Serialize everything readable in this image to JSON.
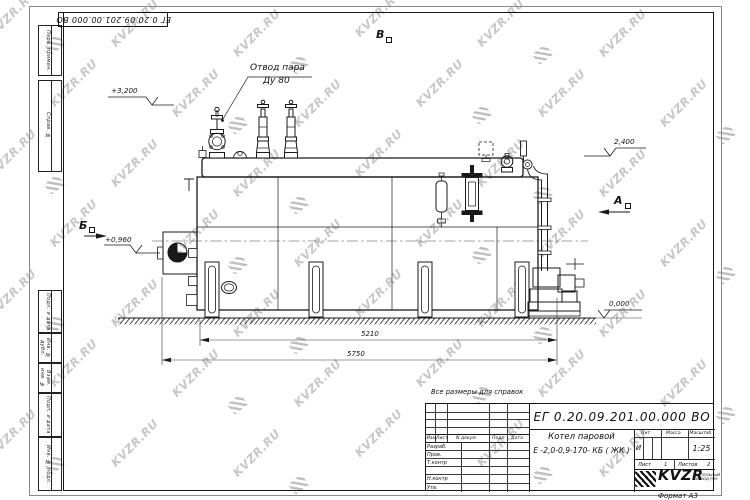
{
  "page": {
    "format_label": "Формат А3"
  },
  "corner_stamp": {
    "doc_number": "ЕГ 0.20.09.201.00.000  ВО"
  },
  "left_margin": {
    "boxes": [
      {
        "label": "Перв. примен."
      },
      {
        "label": "Справ. №"
      },
      {
        "label": "Подп. и дата"
      },
      {
        "label": "Инв. № дубл."
      },
      {
        "label": "Взам. инв. №"
      },
      {
        "label": "Подп. и дата"
      },
      {
        "label": "Инв. № подл."
      }
    ]
  },
  "annotations": {
    "note": "Все размеры для справок",
    "steam_outlet_line1": "Отвод пара",
    "steam_outlet_line2": "Ду 80",
    "elev_3200": "+3,200",
    "elev_0960": "+0,960",
    "elev_2400": "2,400",
    "elev_0000": "0,000",
    "view_b": "Б",
    "view_v": "В",
    "view_a": "А",
    "dim_5210": "5210",
    "dim_5750": "5750"
  },
  "title_block": {
    "doc_number": "ЕГ 0.20.09.201.00.000  ВО",
    "name_line1": "Котел паровой",
    "name_line2": "Е -2,0-0,9-170- КБ ( ЖК )",
    "header_cols": {
      "izm": "Изм",
      "list": "Лист",
      "ndokum": "N докум",
      "podp": "Подп",
      "data": "Дата"
    },
    "sig_rows": {
      "r0": "Разраб.",
      "r1": "Пров.",
      "r2": "Т.контр",
      "r3": "Н.контр",
      "r4": "Утв."
    },
    "lit_label": "Лит",
    "massa_label": "Масса",
    "masshtab_label": "Масштаб",
    "lit_value": "И",
    "masshtab_value": "1:25",
    "list_label": "Лист",
    "list_value": "1",
    "listov_label": "Листов",
    "listov_value": "2",
    "logo_text": "KVZR",
    "logo_sub1": "КОТЕЛЬНЫЙ",
    "logo_sub2": "ЗАВОД РЭУ"
  },
  "watermark": {
    "text": "KVZR.RU",
    "text_color": "#c7c7c7",
    "mark_color": "#bfbfbf"
  }
}
